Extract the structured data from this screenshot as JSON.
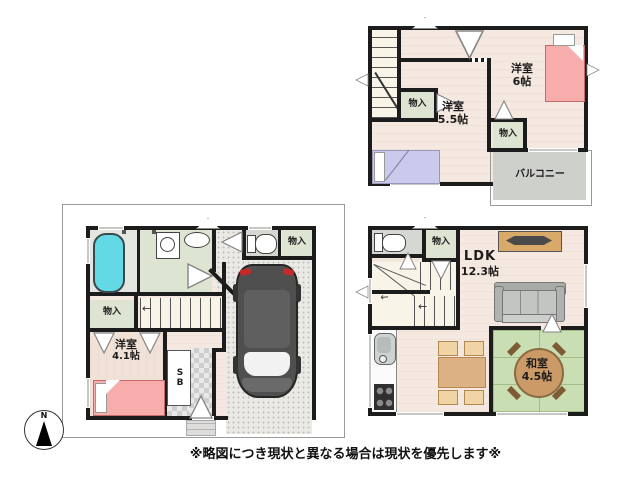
{
  "meta": {
    "note": "※略図につき現状と異なる場合は現状を優先します※"
  },
  "compass": {
    "north": "N"
  },
  "left_plan": {
    "bedroom_41": {
      "name": "洋室",
      "size": "4.1帖"
    },
    "closet_hall": {
      "label": "物入"
    },
    "closet_toilet": {
      "label": "物入"
    },
    "shoe_box": {
      "label": "SB"
    }
  },
  "top_right_plan": {
    "bedroom_6": {
      "name": "洋室",
      "size": "6帖"
    },
    "bedroom_55": {
      "name": "洋室",
      "size": "5.5帖"
    },
    "closet_hall": {
      "label": "物入"
    },
    "closet_6": {
      "label": "物入"
    },
    "balcony": {
      "label": "バルコニー"
    }
  },
  "bottom_right_plan": {
    "ldk": {
      "name": "LDK",
      "size": "12.3帖"
    },
    "washitsu": {
      "name": "和室",
      "size": "4.5帖"
    },
    "closet": {
      "label": "物入"
    }
  },
  "colors": {
    "wall": "#1c1c1c",
    "wood": "#f4e8e0",
    "woodp": "#f1e2d8",
    "green": "#dde4d2",
    "tatami": "#c9deb3",
    "bgray": "#ced1cb",
    "cyan": "#63d9e6",
    "pink": "#f8adad",
    "purple": "#c9caec",
    "sofa": "#c3c5c2",
    "tan": "#d9a96a",
    "ttan": "#dcb285",
    "conc": "#ebe9e5",
    "pale": "#f8f4e8",
    "tile": "#d4d7d2",
    "wingray": "#c6c8c3"
  }
}
